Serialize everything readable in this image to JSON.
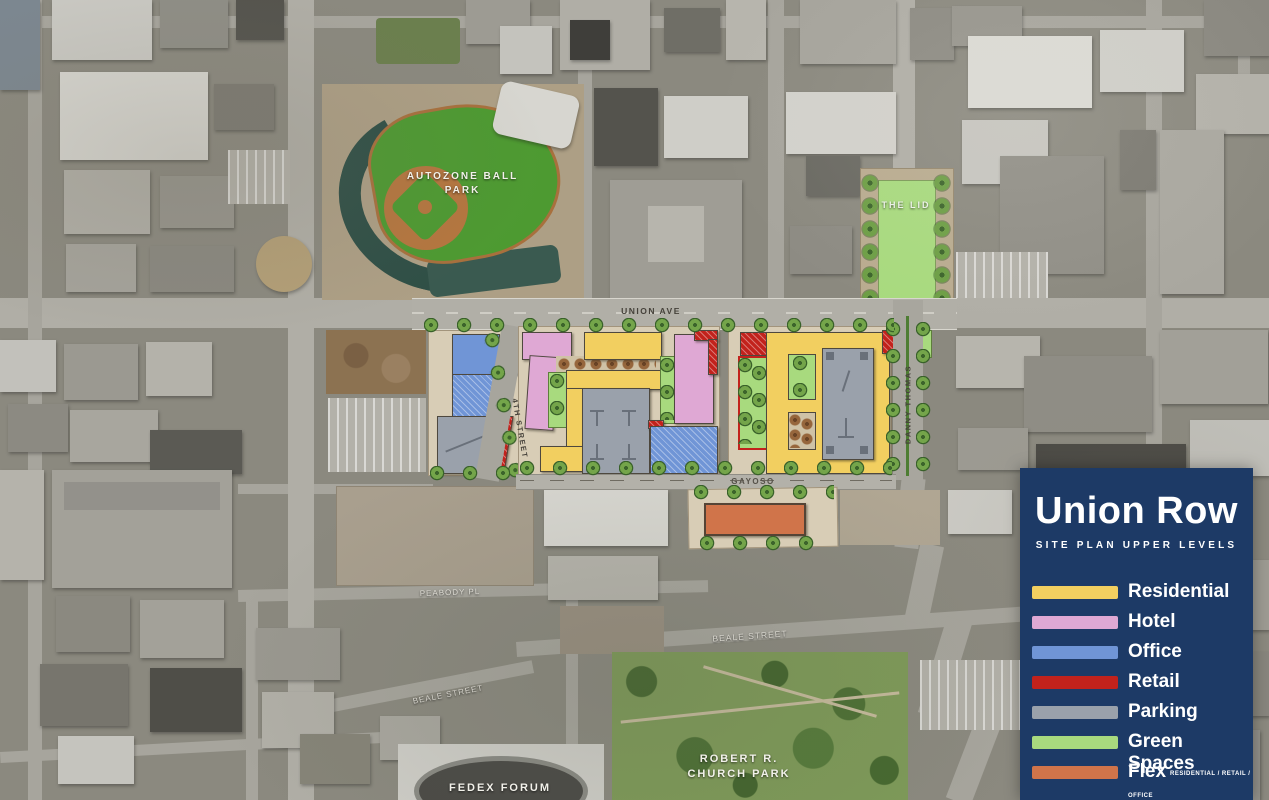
{
  "legend": {
    "title": "Union Row",
    "subtitle": "SITE PLAN UPPER LEVELS",
    "items": [
      {
        "label": "Residential"
      },
      {
        "label": "Hotel"
      },
      {
        "label": "Office"
      },
      {
        "label": "Retail"
      },
      {
        "label": "Parking"
      },
      {
        "label": "Green Spaces"
      },
      {
        "label": "Flex",
        "note": "RESIDENTIAL / RETAIL / OFFICE"
      }
    ]
  },
  "colors": {
    "panel": "#1d3a66",
    "residential": "#f2cf60",
    "hotel": "#dfa8d4",
    "office": "#7095d6",
    "retail": "#c2221c",
    "parking": "#9aa1ab",
    "green_spaces": "#a8da7e",
    "flex": "#d0744a"
  },
  "map_labels": {
    "ballpark": "AUTOZONE BALL PARK",
    "the_lid": "THE LID",
    "church_park": "ROBERT R. CHURCH PARK",
    "fedex_forum": "FEDEX FORUM"
  },
  "street_labels": {
    "union_ave": "UNION AVE",
    "gayoso": "GAYOSO",
    "fourth_street": "4TH STREET",
    "danny_thomas": "DANNY THOMAS",
    "peabody_pl": "PEABODY PL",
    "beale_street": "BEALE STREET"
  }
}
